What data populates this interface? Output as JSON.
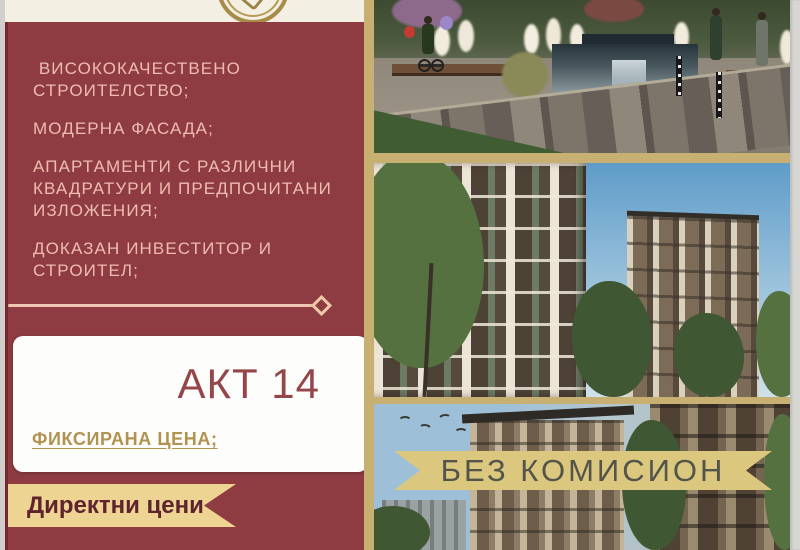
{
  "flyer": {
    "type": "real-estate-ad",
    "features": [
      " ВИСОКОКАЧЕСТВЕНО СТРОИТЕЛСТВО;",
      "МОДЕРНА ФАСАДА;",
      "АПАРТАМЕНТИ С РАЗЛИЧНИ КВАДРАТУРИ И ПРЕДПОЧИТАНИ ИЗЛОЖЕНИЯ;",
      "ДОКАЗАН ИНВЕСТИТОР И СТРОИТЕЛ;"
    ],
    "card": {
      "act_label": "АКТ 14",
      "fixed_price_label": "ФИКСИРАНА ЦЕНА;"
    },
    "direct_prices_label": "Директни цени",
    "no_commission_label": "БЕЗ КОМИСИОН",
    "colors": {
      "panel_maroon": "#8e3c42",
      "feature_text_pink": "#efbcaf",
      "header_cream": "#f3efe2",
      "right_background_gold": "#c7b072",
      "ribbon_gold": "#eed492",
      "banner_gold": "#dcc77f",
      "akt_maroon": "#95464b",
      "fixed_price_gold": "#b29251",
      "ribbon_text_maroon": "#5e232d",
      "banner_text_olive": "#53544a"
    }
  }
}
